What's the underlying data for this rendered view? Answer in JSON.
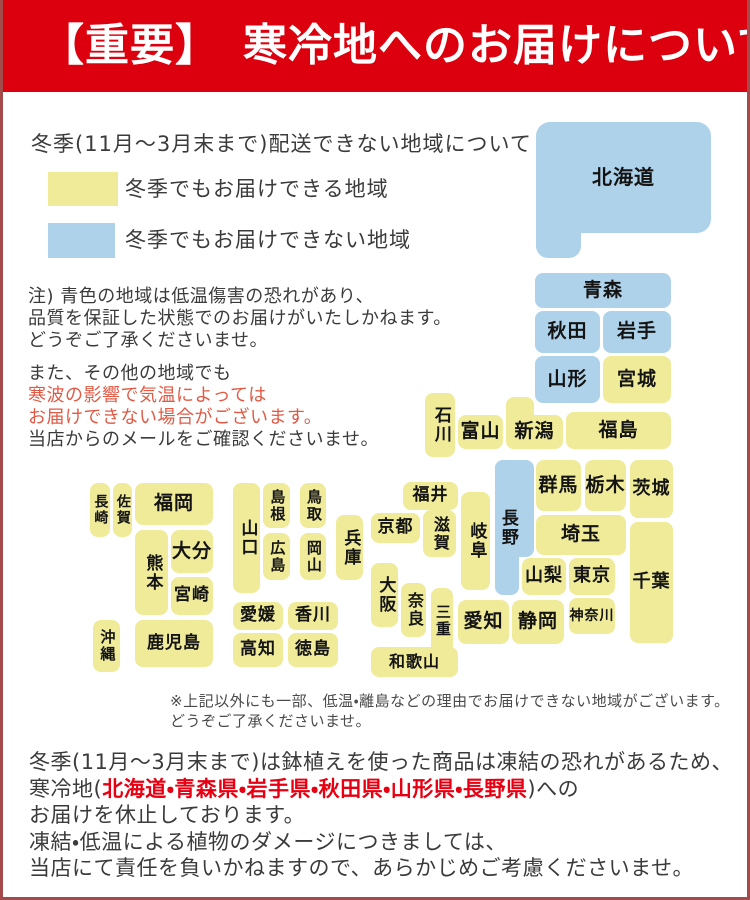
{
  "colors": {
    "header-bg": "#dc000e",
    "block-yellow": "#f0eb99",
    "block-blue": "#aed2ea",
    "warning-red": "#e05a45",
    "accent-red": "#e60012",
    "page-border": "#a34a4a",
    "body-text": "#3b3b3b",
    "map-text": "#141414"
  },
  "header": {
    "title": "【重要】　寒冷地へのお届けについて"
  },
  "legend": {
    "title": "冬季(11月～3月末まで)配送できない地域について",
    "items": [
      {
        "name": "winter-deliverable",
        "label": "冬季でもお届けできる地域",
        "color": "#f0eb99"
      },
      {
        "name": "winter-not-deliverable",
        "label": "冬季でもお届けできない地域",
        "color": "#aed2ea"
      }
    ]
  },
  "notes": {
    "p1": [
      "注) 青色の地域は低温傷害の恐れがあり、",
      "品質を保証した状態でのお届けがいたしかねます。",
      "どうぞご了承くださいませ。"
    ],
    "p2": [
      "また、その他の地域でも",
      "寒波の影響で気温によっては",
      "お届けできない場合がございます。",
      "当店からのメールをご確認くださいませ。"
    ]
  },
  "map": {
    "blue_means": "冬季お届け不可",
    "yellow_means": "冬季お届け可",
    "blocks": [
      {
        "id": "hokkaido",
        "label": "北海道",
        "x": 533,
        "y": 122,
        "w": 175,
        "h": 111,
        "c": "b",
        "fs": 20,
        "r": "14px"
      },
      {
        "id": "hokkaido-foot",
        "label": "",
        "x": 533,
        "y": 200,
        "w": 45,
        "h": 58,
        "c": "b",
        "r": "0 0 12px 12px"
      },
      {
        "id": "aomori",
        "label": "青森",
        "x": 532,
        "y": 273,
        "w": 136,
        "h": 35,
        "c": "b"
      },
      {
        "id": "akita",
        "label": "秋田",
        "x": 532,
        "y": 311,
        "w": 65,
        "h": 42,
        "c": "b"
      },
      {
        "id": "iwate",
        "label": "岩手",
        "x": 600,
        "y": 311,
        "w": 68,
        "h": 42,
        "c": "b"
      },
      {
        "id": "yamagata",
        "label": "山形",
        "x": 532,
        "y": 356,
        "w": 65,
        "h": 47,
        "c": "b"
      },
      {
        "id": "miyagi",
        "label": "宮城",
        "x": 600,
        "y": 356,
        "w": 68,
        "h": 47,
        "c": "y"
      },
      {
        "id": "fukushima",
        "label": "福島",
        "x": 563,
        "y": 412,
        "w": 105,
        "h": 37,
        "c": "y"
      },
      {
        "id": "niigata-north",
        "label": "",
        "x": 503,
        "y": 397,
        "w": 28,
        "h": 52,
        "c": "y"
      },
      {
        "id": "niigata",
        "label": "新潟",
        "x": 503,
        "y": 415,
        "w": 57,
        "h": 34,
        "c": "y"
      },
      {
        "id": "toyama",
        "label": "富山",
        "x": 455,
        "y": 415,
        "w": 45,
        "h": 34,
        "c": "y"
      },
      {
        "id": "ishikawa",
        "label": "石川",
        "x": 422,
        "y": 393,
        "w": 30,
        "h": 64,
        "c": "y",
        "o": "v"
      },
      {
        "id": "fukui",
        "label": "福井",
        "x": 400,
        "y": 482,
        "w": 55,
        "h": 28,
        "c": "y",
        "fs": 17
      },
      {
        "id": "gunma",
        "label": "群馬",
        "x": 533,
        "y": 460,
        "w": 45,
        "h": 51,
        "c": "y"
      },
      {
        "id": "tochigi",
        "label": "栃木",
        "x": 582,
        "y": 460,
        "w": 41,
        "h": 51,
        "c": "y"
      },
      {
        "id": "ibaraki",
        "label": "茨城",
        "x": 627,
        "y": 460,
        "w": 43,
        "h": 58,
        "c": "y",
        "fs": 18
      },
      {
        "id": "saitama",
        "label": "埼玉",
        "x": 533,
        "y": 515,
        "w": 90,
        "h": 40,
        "c": "y"
      },
      {
        "id": "nagano-main",
        "label": "",
        "x": 492,
        "y": 460,
        "w": 39,
        "h": 97,
        "c": "b"
      },
      {
        "id": "nagano",
        "label": "長野",
        "x": 492,
        "y": 460,
        "w": 24,
        "h": 135,
        "c": "b",
        "o": "v"
      },
      {
        "id": "yamanashi",
        "label": "山梨",
        "x": 519,
        "y": 558,
        "w": 44,
        "h": 37,
        "c": "y",
        "fs": 18
      },
      {
        "id": "tokyo",
        "label": "東京",
        "x": 566,
        "y": 558,
        "w": 46,
        "h": 37,
        "c": "y",
        "fs": 18
      },
      {
        "id": "chiba",
        "label": "千葉",
        "x": 627,
        "y": 522,
        "w": 43,
        "h": 121,
        "c": "y",
        "fs": 18
      },
      {
        "id": "kanagawa",
        "label": "神奈川",
        "x": 566,
        "y": 598,
        "w": 46,
        "h": 36,
        "c": "y",
        "fs": 14
      },
      {
        "id": "shizuoka",
        "label": "静岡",
        "x": 509,
        "y": 600,
        "w": 52,
        "h": 44,
        "c": "y"
      },
      {
        "id": "aichi",
        "label": "愛知",
        "x": 455,
        "y": 600,
        "w": 51,
        "h": 44,
        "c": "y"
      },
      {
        "id": "gifu",
        "label": "岐阜",
        "x": 458,
        "y": 492,
        "w": 29,
        "h": 98,
        "c": "y",
        "o": "v"
      },
      {
        "id": "shiga",
        "label": "滋賀",
        "x": 420,
        "y": 510,
        "w": 33,
        "h": 47,
        "c": "y",
        "o": "v",
        "fs": 16
      },
      {
        "id": "kyoto",
        "label": "京都",
        "x": 368,
        "y": 513,
        "w": 49,
        "h": 30,
        "c": "y",
        "fs": 17
      },
      {
        "id": "osaka",
        "label": "大阪",
        "x": 368,
        "y": 563,
        "w": 27,
        "h": 64,
        "c": "y",
        "o": "v"
      },
      {
        "id": "nara",
        "label": "奈良",
        "x": 398,
        "y": 583,
        "w": 25,
        "h": 54,
        "c": "y",
        "o": "v",
        "fs": 16
      },
      {
        "id": "mie",
        "label": "三重",
        "x": 428,
        "y": 588,
        "w": 22,
        "h": 66,
        "c": "y",
        "o": "v",
        "fs": 15
      },
      {
        "id": "wakayama",
        "label": "和歌山",
        "x": 368,
        "y": 647,
        "w": 87,
        "h": 30,
        "c": "y",
        "fs": 16
      },
      {
        "id": "hyogo",
        "label": "兵庫",
        "x": 333,
        "y": 515,
        "w": 27,
        "h": 65,
        "c": "y",
        "o": "v"
      },
      {
        "id": "tottori",
        "label": "鳥取",
        "x": 297,
        "y": 483,
        "w": 26,
        "h": 45,
        "c": "y",
        "o": "v",
        "fs": 15
      },
      {
        "id": "okayama",
        "label": "岡山",
        "x": 297,
        "y": 533,
        "w": 26,
        "h": 47,
        "c": "y",
        "o": "v",
        "fs": 15
      },
      {
        "id": "shimane",
        "label": "島根",
        "x": 260,
        "y": 483,
        "w": 27,
        "h": 45,
        "c": "y",
        "o": "v",
        "fs": 15
      },
      {
        "id": "hiroshima",
        "label": "広島",
        "x": 260,
        "y": 533,
        "w": 27,
        "h": 47,
        "c": "y",
        "o": "v",
        "fs": 15
      },
      {
        "id": "yamaguchi",
        "label": "山口",
        "x": 230,
        "y": 483,
        "w": 27,
        "h": 110,
        "c": "y",
        "o": "v"
      },
      {
        "id": "ehime",
        "label": "愛媛",
        "x": 230,
        "y": 602,
        "w": 50,
        "h": 28,
        "c": "y",
        "fs": 17
      },
      {
        "id": "kagawa",
        "label": "香川",
        "x": 285,
        "y": 602,
        "w": 50,
        "h": 28,
        "c": "y",
        "fs": 17
      },
      {
        "id": "kochi",
        "label": "高知",
        "x": 230,
        "y": 633,
        "w": 50,
        "h": 34,
        "c": "y",
        "fs": 17
      },
      {
        "id": "tokushima",
        "label": "徳島",
        "x": 285,
        "y": 633,
        "w": 50,
        "h": 34,
        "c": "y",
        "fs": 17
      },
      {
        "id": "fukuoka",
        "label": "福岡",
        "x": 132,
        "y": 483,
        "w": 78,
        "h": 42,
        "c": "y"
      },
      {
        "id": "saga",
        "label": "佐賀",
        "x": 110,
        "y": 483,
        "w": 19,
        "h": 54,
        "c": "y",
        "o": "v",
        "fs": 14
      },
      {
        "id": "nagasaki",
        "label": "長崎",
        "x": 87,
        "y": 483,
        "w": 20,
        "h": 54,
        "c": "y",
        "o": "v",
        "fs": 14
      },
      {
        "id": "kumamoto",
        "label": "熊本",
        "x": 132,
        "y": 530,
        "w": 33,
        "h": 85,
        "c": "y",
        "o": "v"
      },
      {
        "id": "oita",
        "label": "大分",
        "x": 168,
        "y": 530,
        "w": 42,
        "h": 43,
        "c": "y"
      },
      {
        "id": "miyazaki",
        "label": "宮崎",
        "x": 168,
        "y": 577,
        "w": 42,
        "h": 38,
        "c": "y",
        "fs": 17
      },
      {
        "id": "kagoshima",
        "label": "鹿児島",
        "x": 132,
        "y": 620,
        "w": 78,
        "h": 47,
        "c": "y",
        "fs": 17
      },
      {
        "id": "okinawa",
        "label": "沖縄",
        "x": 90,
        "y": 620,
        "w": 27,
        "h": 52,
        "c": "y",
        "o": "v",
        "fs": 15
      }
    ]
  },
  "footnote": [
    "※上記以外にも一部、低温・離島などの理由でお届けできない地域がございます。",
    "どうぞご了承くださいませ。"
  ],
  "footer": {
    "line1": "冬季(11月～3月末まで)は鉢植えを使った商品は凍結の恐れがあるため、",
    "line2_prefix": "寒冷地(",
    "line2_red": "北海道・青森県・岩手県・秋田県・山形県・長野県",
    "line2_suffix": ")への",
    "line3": "お届けを休止しております。",
    "line4": "凍結・低温による植物のダメージにつきましては、",
    "line5": "当店にて責任を負いかねますので、あらかじめご考慮くださいませ。"
  }
}
